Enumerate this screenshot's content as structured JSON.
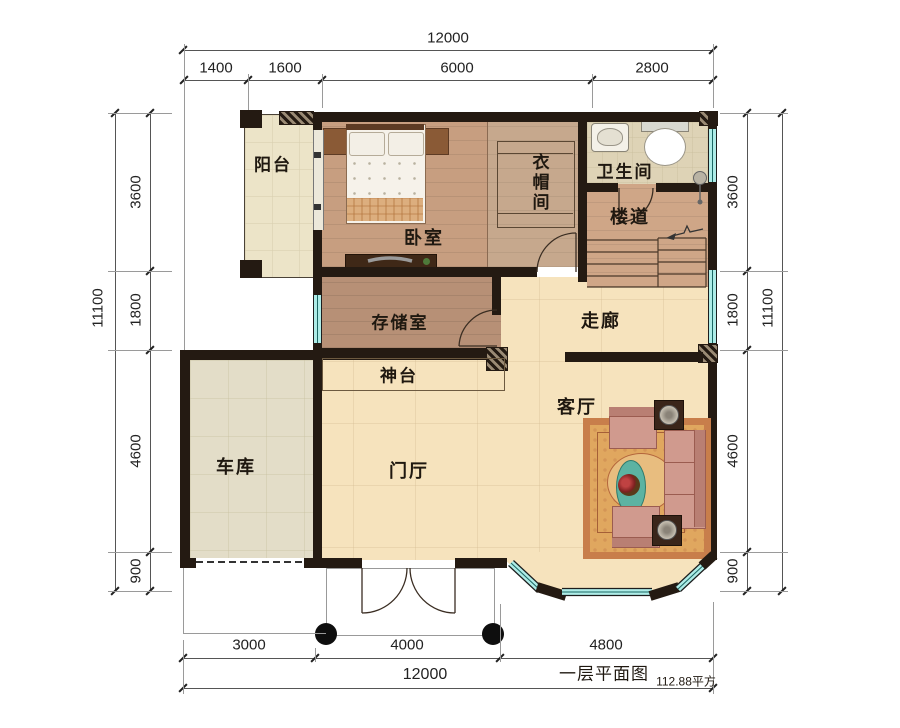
{
  "title": {
    "name": "一层平面图",
    "area": "112.88平方"
  },
  "rooms": {
    "balcony": "阳台",
    "bedroom": "卧室",
    "cloakroom": "衣帽间",
    "bathroom": "卫生间",
    "stairwell": "楼道",
    "storage": "存储室",
    "hallway": "走廊",
    "altar": "神台",
    "garage": "车库",
    "foyer": "门厅",
    "living": "客厅"
  },
  "dims": {
    "top": {
      "overall": "12000",
      "segments": [
        "1400",
        "1600",
        "6000",
        "2800"
      ]
    },
    "left": {
      "overall": "11100",
      "segments": [
        "3600",
        "1800",
        "4600",
        "900"
      ]
    },
    "right": {
      "overall": "11100",
      "segments": [
        "3600",
        "1800",
        "4600",
        "900"
      ]
    },
    "bottom": {
      "overall": "12000",
      "segments": [
        "3000",
        "4000",
        "4800"
      ]
    }
  },
  "colors": {
    "wall": "#241a12",
    "glass": "#aeece7",
    "floor_hall": "#f6e3bd",
    "floor_wood": "#c79e80",
    "rug": "#d89a55"
  }
}
